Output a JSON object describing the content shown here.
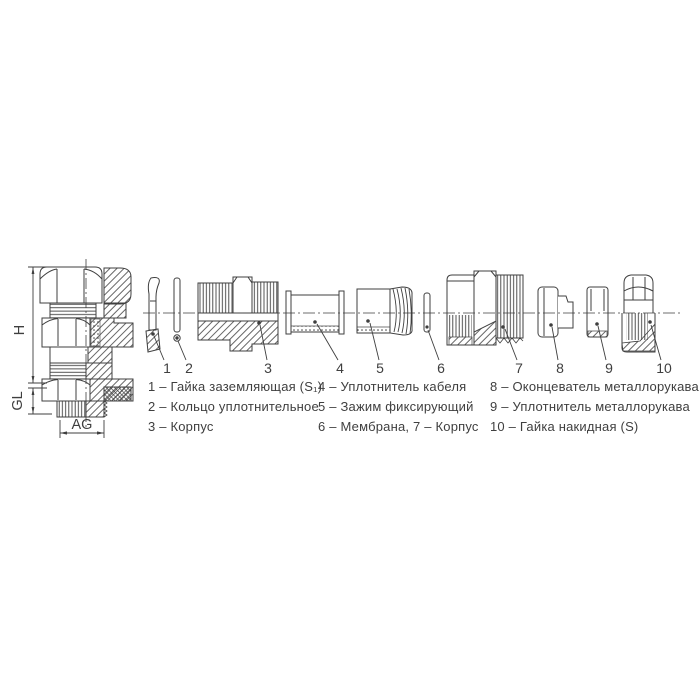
{
  "colors": {
    "line": "#3f3f3f",
    "background": "#ffffff"
  },
  "assembled_view": {
    "dim_height": "H",
    "dim_gland_length": "GL",
    "dim_thread": "AG"
  },
  "exploded_view": {
    "part_numbers": [
      "1",
      "2",
      "3",
      "4",
      "5",
      "6",
      "7",
      "8",
      "9",
      "10"
    ]
  },
  "legend": {
    "columns": [
      {
        "items": [
          "1 – Гайка заземляющая (S₁)",
          "2 – Кольцо уплотнительное",
          "3 – Корпус"
        ]
      },
      {
        "items": [
          "4 – Уплотнитель кабеля",
          "5 – Зажим фиксирующий",
          "6 – Мембрана, 7 – Корпус"
        ]
      },
      {
        "items": [
          "8 – Оконцеватель металлорукава",
          "9 – Уплотнитель металлорукава",
          "10 – Гайка накидная (S)"
        ]
      }
    ]
  }
}
